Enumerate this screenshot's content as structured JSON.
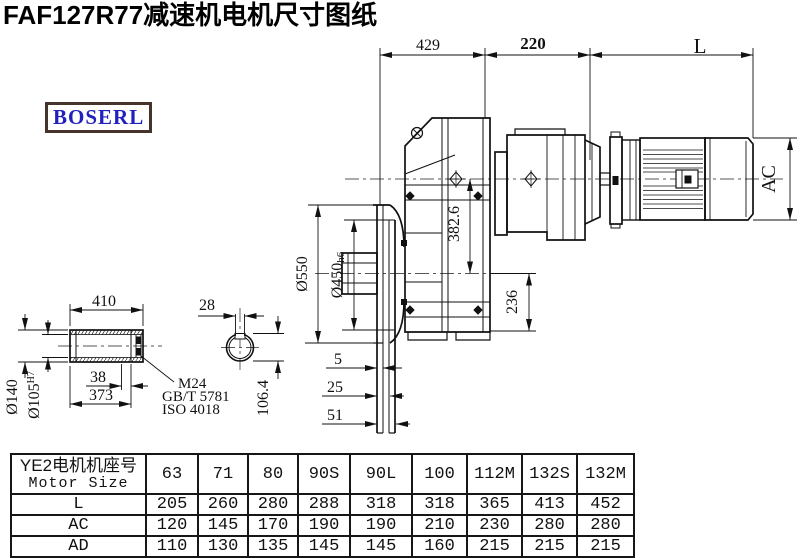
{
  "title": "FAF127R77减速机电机尺寸图纸",
  "brand": "BOSERL",
  "dims": {
    "t429": "429",
    "t220": "220",
    "tL": "L",
    "ac": "AC",
    "center_dist": "382.6",
    "d550": "Ø550",
    "d450": "Ø450",
    "d450_tol": "h6",
    "d236": "236",
    "s410": "410",
    "s28": "28",
    "d140": "Ø140",
    "d105": "Ø105",
    "d105_tol": "H7",
    "s38": "38",
    "s373": "373",
    "thread": "M24",
    "std1": "GB/T 5781",
    "std2": "ISO 4018",
    "k1064": "106.4",
    "f5": "5",
    "f25": "25",
    "f51": "51"
  },
  "table": {
    "header_cn": "YE2电机机座号",
    "header_en": "Motor Size",
    "columns": [
      "63",
      "71",
      "80",
      "90S",
      "90L",
      "100",
      "112M",
      "132S",
      "132M"
    ],
    "rows": [
      {
        "label": "L",
        "values": [
          "205",
          "260",
          "280",
          "288",
          "318",
          "318",
          "365",
          "413",
          "452"
        ]
      },
      {
        "label": "AC",
        "values": [
          "120",
          "145",
          "170",
          "190",
          "190",
          "210",
          "230",
          "280",
          "280"
        ]
      },
      {
        "label": "AD",
        "values": [
          "110",
          "130",
          "135",
          "145",
          "145",
          "160",
          "215",
          "215",
          "215"
        ]
      }
    ]
  }
}
